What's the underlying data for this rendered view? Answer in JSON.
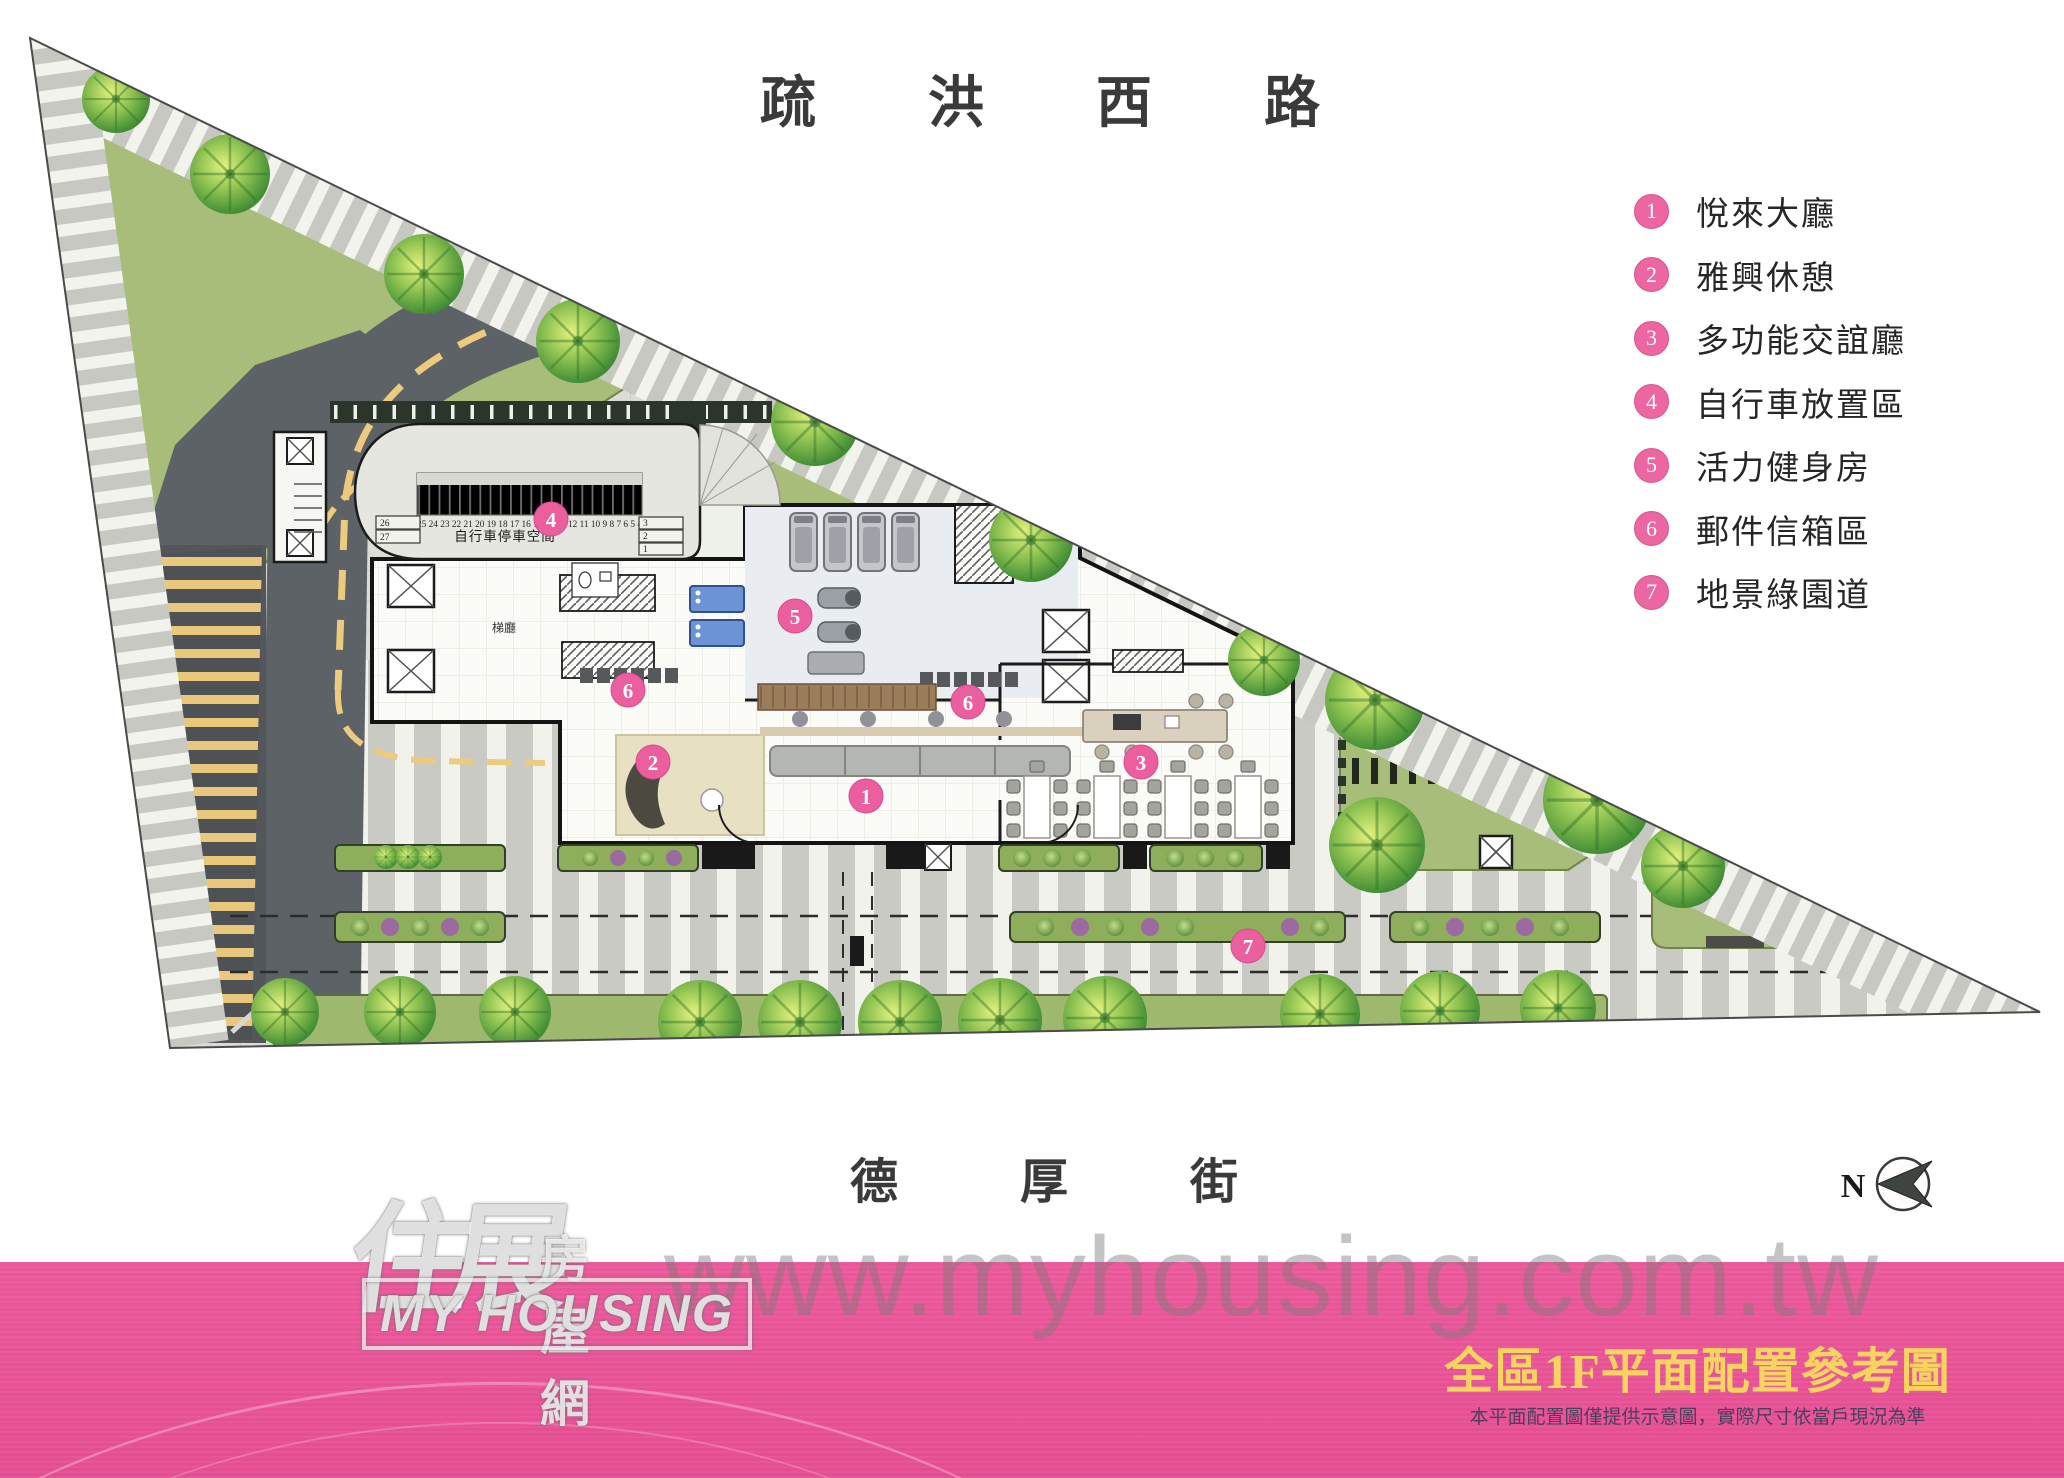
{
  "site": {
    "road_top": "疏洪西路",
    "road_bottom": "德厚街"
  },
  "legend": {
    "items": [
      {
        "num": "1",
        "label": "悅來大廳"
      },
      {
        "num": "2",
        "label": "雅興休憩"
      },
      {
        "num": "3",
        "label": "多功能交誼廳"
      },
      {
        "num": "4",
        "label": "自行車放置區"
      },
      {
        "num": "5",
        "label": "活力健身房"
      },
      {
        "num": "6",
        "label": "郵件信箱區"
      },
      {
        "num": "7",
        "label": "地景綠園道"
      }
    ]
  },
  "plan": {
    "bike_area_label": "自行車停車空間",
    "bike_stalls_top": "25 24 23 22 21 20 19 18 17 16 15 14 13 12 11 10 9 8 7 6 5 4",
    "bike_stalls_left": [
      "26",
      "27"
    ],
    "bike_stalls_right": [
      "3",
      "2",
      "1"
    ],
    "hall_label": "梯廳",
    "markers": [
      {
        "num": "1"
      },
      {
        "num": "2"
      },
      {
        "num": "3"
      },
      {
        "num": "4"
      },
      {
        "num": "5"
      },
      {
        "num": "6"
      },
      {
        "num": "6"
      },
      {
        "num": "7"
      }
    ]
  },
  "compass": {
    "label": "N"
  },
  "watermark": {
    "url": "www.myhousing.com.tw",
    "logo_zh": "住展",
    "logo_zh_suffix": "房屋網",
    "logo_en_line": "MY HOUSING"
  },
  "footer": {
    "title": "全區1F平面配置參考圖",
    "disclaimer": "本平面配置圖僅提供示意圖，實際尺寸依當戶現況為準"
  },
  "colors": {
    "banner_pink": "#e85196",
    "marker_pink": "#ec5f9f",
    "title_yellow": "#f7d45f",
    "lawn_green": "#a9bd7a"
  }
}
